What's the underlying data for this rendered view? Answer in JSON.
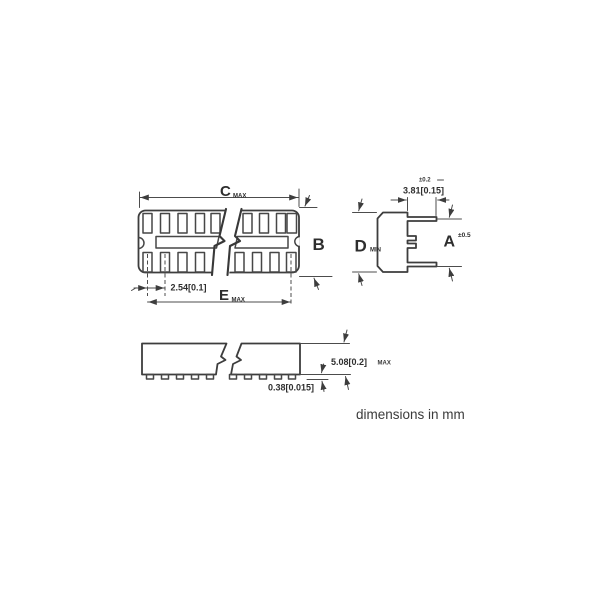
{
  "footer": {
    "units_note": "dimensions in mm"
  },
  "top_view": {
    "dim_width_letter": "C",
    "dim_width_qualifier": "MAX",
    "dim_span_letter": "E",
    "dim_span_qualifier": "MAX",
    "dim_depth_letter": "B",
    "pin_pitch": "2.54[0.1]"
  },
  "end_view": {
    "dim_height_letter": "D",
    "dim_height_qualifier": "MIN",
    "dim_overall_letter": "A",
    "dim_overall_tolerance": "±0.5",
    "contact_offset": "3.81[0.15]",
    "contact_offset_tolerance": "±0.2"
  },
  "side_view": {
    "body_height": "5.08[0.2]",
    "body_height_qualifier": "MAX",
    "standoff_height": "0.38[0.015]"
  }
}
